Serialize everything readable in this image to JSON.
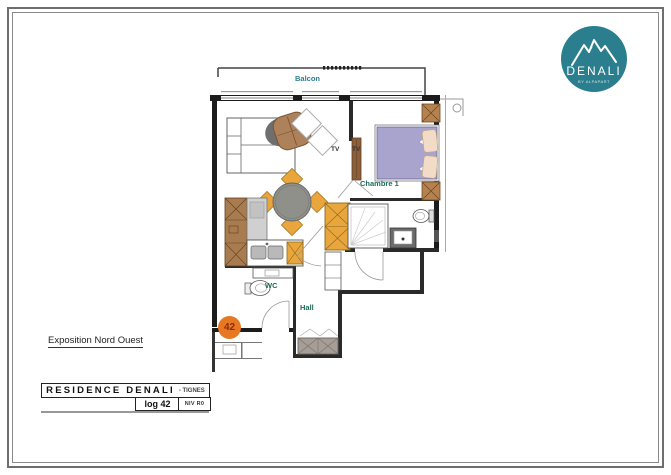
{
  "logo": {
    "title": "DENALI",
    "subtitle": "BY ALPAPART",
    "icon": "mountain-icon",
    "bg_color": "#2b7e8e"
  },
  "plan": {
    "labels": {
      "balcony": "Balcon",
      "bedroom": "Chambre 1",
      "tv_living": "TV",
      "tv_bedroom": "TV",
      "wc": "WC",
      "hall": "Hall"
    },
    "unit_badge": "42",
    "colors": {
      "badge": "#e87722",
      "wood_cabinet": "#a97c50",
      "accent_furniture": "#e9a63c",
      "bed_duvet": "#a8a4ce",
      "hall_wardrobe": "#a59d96",
      "label_green": "#1d6b58",
      "label_teal": "#2e7d8c"
    }
  },
  "notes": {
    "exposition": "Exposition Nord Ouest"
  },
  "title_block": {
    "residence": "RESIDENCE DENALI",
    "location": "- TIGNES",
    "unit": "log 42",
    "level": "NIV R0"
  }
}
